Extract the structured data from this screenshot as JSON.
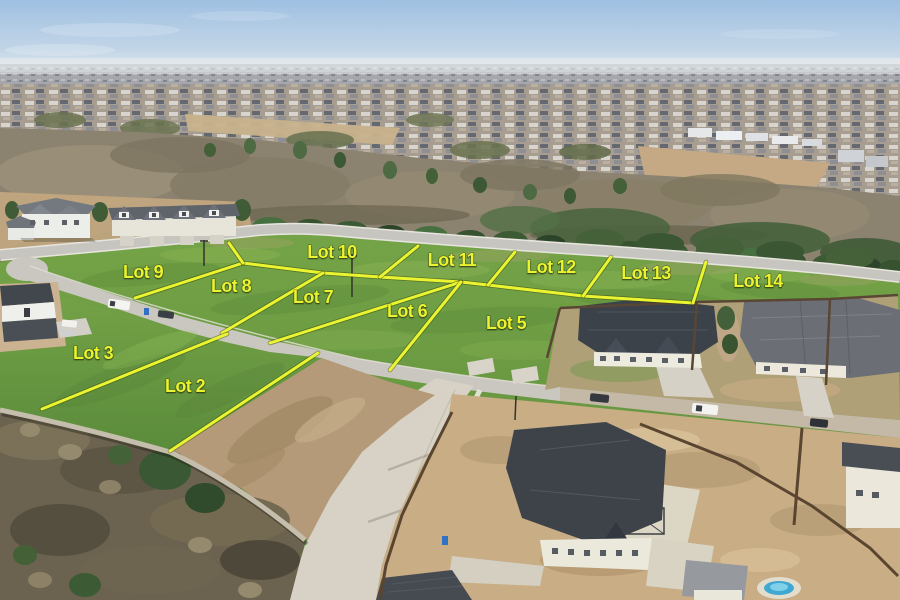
{
  "scene": {
    "kind": "aerial-lot-map-photo",
    "annotation_color": "#eaf431",
    "label_font_size": 18
  },
  "lots": [
    {
      "label": "Lot 9",
      "x": 143,
      "y": 273
    },
    {
      "label": "Lot 8",
      "x": 231,
      "y": 287
    },
    {
      "label": "Lot 10",
      "x": 332,
      "y": 253
    },
    {
      "label": "Lot 7",
      "x": 313,
      "y": 298
    },
    {
      "label": "Lot 11",
      "x": 452,
      "y": 261
    },
    {
      "label": "Lot 6",
      "x": 407,
      "y": 312
    },
    {
      "label": "Lot 12",
      "x": 551,
      "y": 268
    },
    {
      "label": "Lot 5",
      "x": 506,
      "y": 324
    },
    {
      "label": "Lot 13",
      "x": 646,
      "y": 274
    },
    {
      "label": "Lot 14",
      "x": 758,
      "y": 282
    },
    {
      "label": "Lot 3",
      "x": 93,
      "y": 354
    },
    {
      "label": "Lot 2",
      "x": 185,
      "y": 387
    }
  ],
  "boundary_lines": [
    {
      "name": "lot9-lot8",
      "points": [
        [
          135,
          298
        ],
        [
          243,
          263
        ]
      ]
    },
    {
      "name": "mid-split",
      "points": [
        [
          243,
          263
        ],
        [
          323,
          273
        ],
        [
          380,
          277
        ],
        [
          461,
          282
        ],
        [
          488,
          285
        ],
        [
          583,
          296
        ],
        [
          693,
          303
        ]
      ]
    },
    {
      "name": "lot9-lot10",
      "points": [
        [
          243,
          263
        ],
        [
          229,
          243
        ]
      ]
    },
    {
      "name": "lot8-lot7",
      "points": [
        [
          323,
          273
        ],
        [
          222,
          333
        ]
      ]
    },
    {
      "name": "lot10-lot11",
      "points": [
        [
          380,
          277
        ],
        [
          418,
          246
        ]
      ]
    },
    {
      "name": "lot7-lot6",
      "points": [
        [
          461,
          282
        ],
        [
          270,
          343
        ]
      ]
    },
    {
      "name": "lot11-lot12",
      "points": [
        [
          488,
          285
        ],
        [
          515,
          252
        ]
      ]
    },
    {
      "name": "lot6-lot5",
      "points": [
        [
          461,
          282
        ],
        [
          390,
          370
        ]
      ]
    },
    {
      "name": "lot12-lot13",
      "points": [
        [
          583,
          296
        ],
        [
          611,
          257
        ]
      ]
    },
    {
      "name": "lot13-lot14",
      "points": [
        [
          693,
          303
        ],
        [
          706,
          262
        ]
      ]
    },
    {
      "name": "lot3-lot2",
      "points": [
        [
          227,
          334
        ],
        [
          42,
          409
        ]
      ]
    },
    {
      "name": "lot2-east",
      "points": [
        [
          318,
          353
        ],
        [
          170,
          451
        ]
      ]
    }
  ]
}
